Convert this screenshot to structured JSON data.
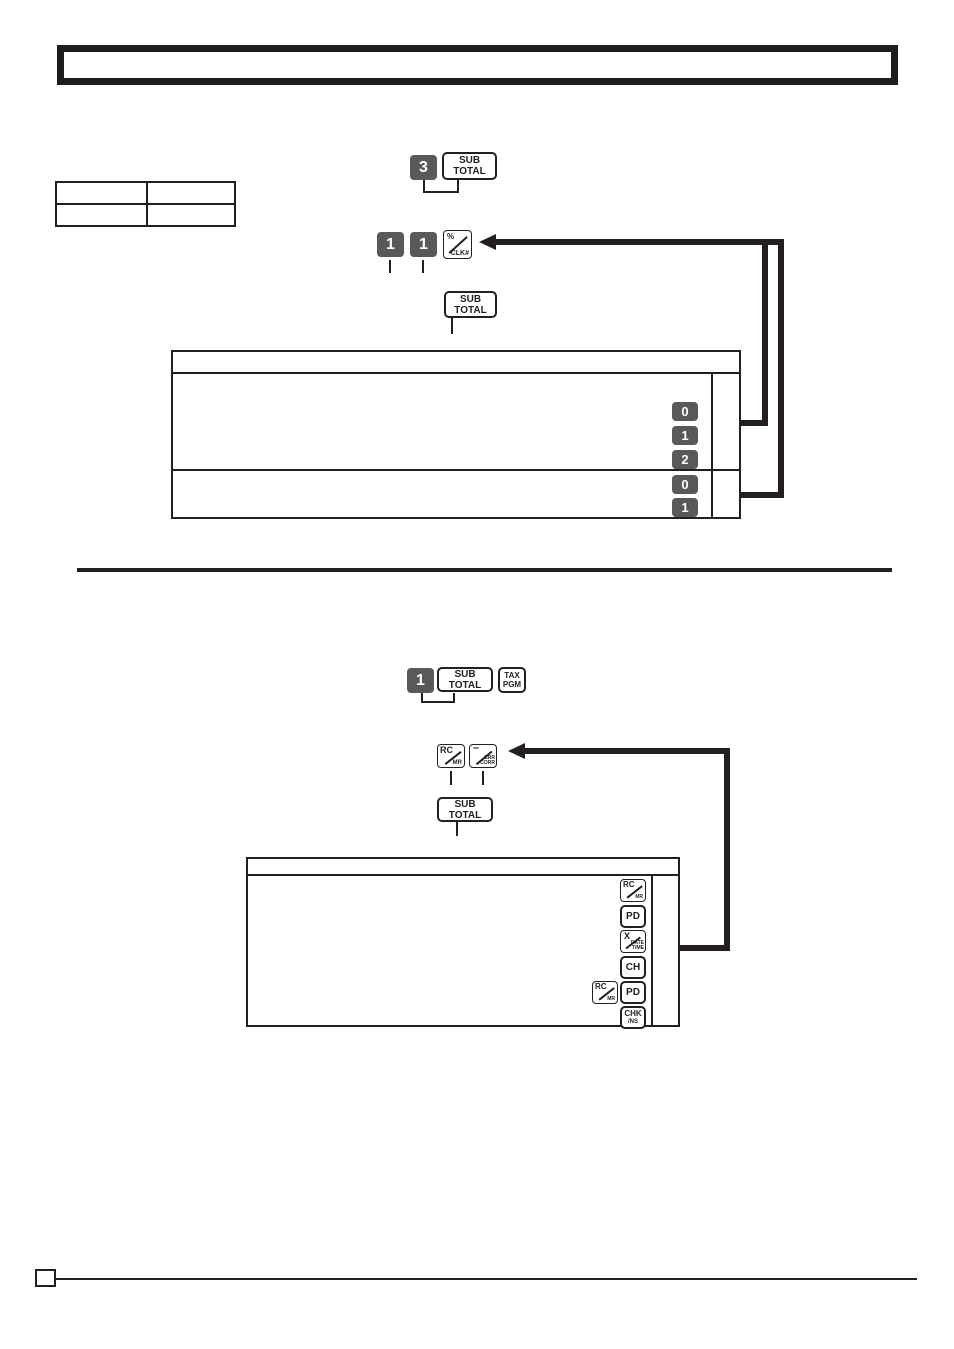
{
  "header": {
    "title": ""
  },
  "sections": {
    "percent_program": {
      "info_table_cells": [
        "",
        "",
        "",
        ""
      ],
      "seq1": {
        "key1": "3",
        "key2": [
          "SUB",
          "TOTAL"
        ]
      },
      "seq2": {
        "key1": "1",
        "key2": "1",
        "key3": {
          "top": "%",
          "bottom": "CLK#"
        }
      },
      "seq3": [
        "SUB",
        "TOTAL"
      ],
      "result_box_keys": [
        "0",
        "1",
        "2",
        "0",
        "1"
      ]
    },
    "tax_program": {
      "seq1": {
        "key1": "1",
        "key2": [
          "SUB",
          "TOTAL"
        ],
        "key3": [
          "TAX",
          "PGM"
        ]
      },
      "seq2": {
        "key1": {
          "top": "RC",
          "bottom": "MR"
        },
        "key2": {
          "top": "–",
          "bottom": [
            "ERR",
            "CORR"
          ]
        }
      },
      "seq3": [
        "SUB",
        "TOTAL"
      ],
      "result_box_keys": [
        {
          "top": "RC",
          "bottom": "MR"
        },
        "PD",
        {
          "top": "X",
          "bottom": [
            "DATE",
            "TIME"
          ]
        },
        "CH",
        {
          "top": "RC",
          "bottom": "MR"
        },
        "PD",
        {
          "top": "CHK",
          "bottom": "/NS"
        }
      ]
    }
  },
  "footer": {
    "page_number": ""
  }
}
